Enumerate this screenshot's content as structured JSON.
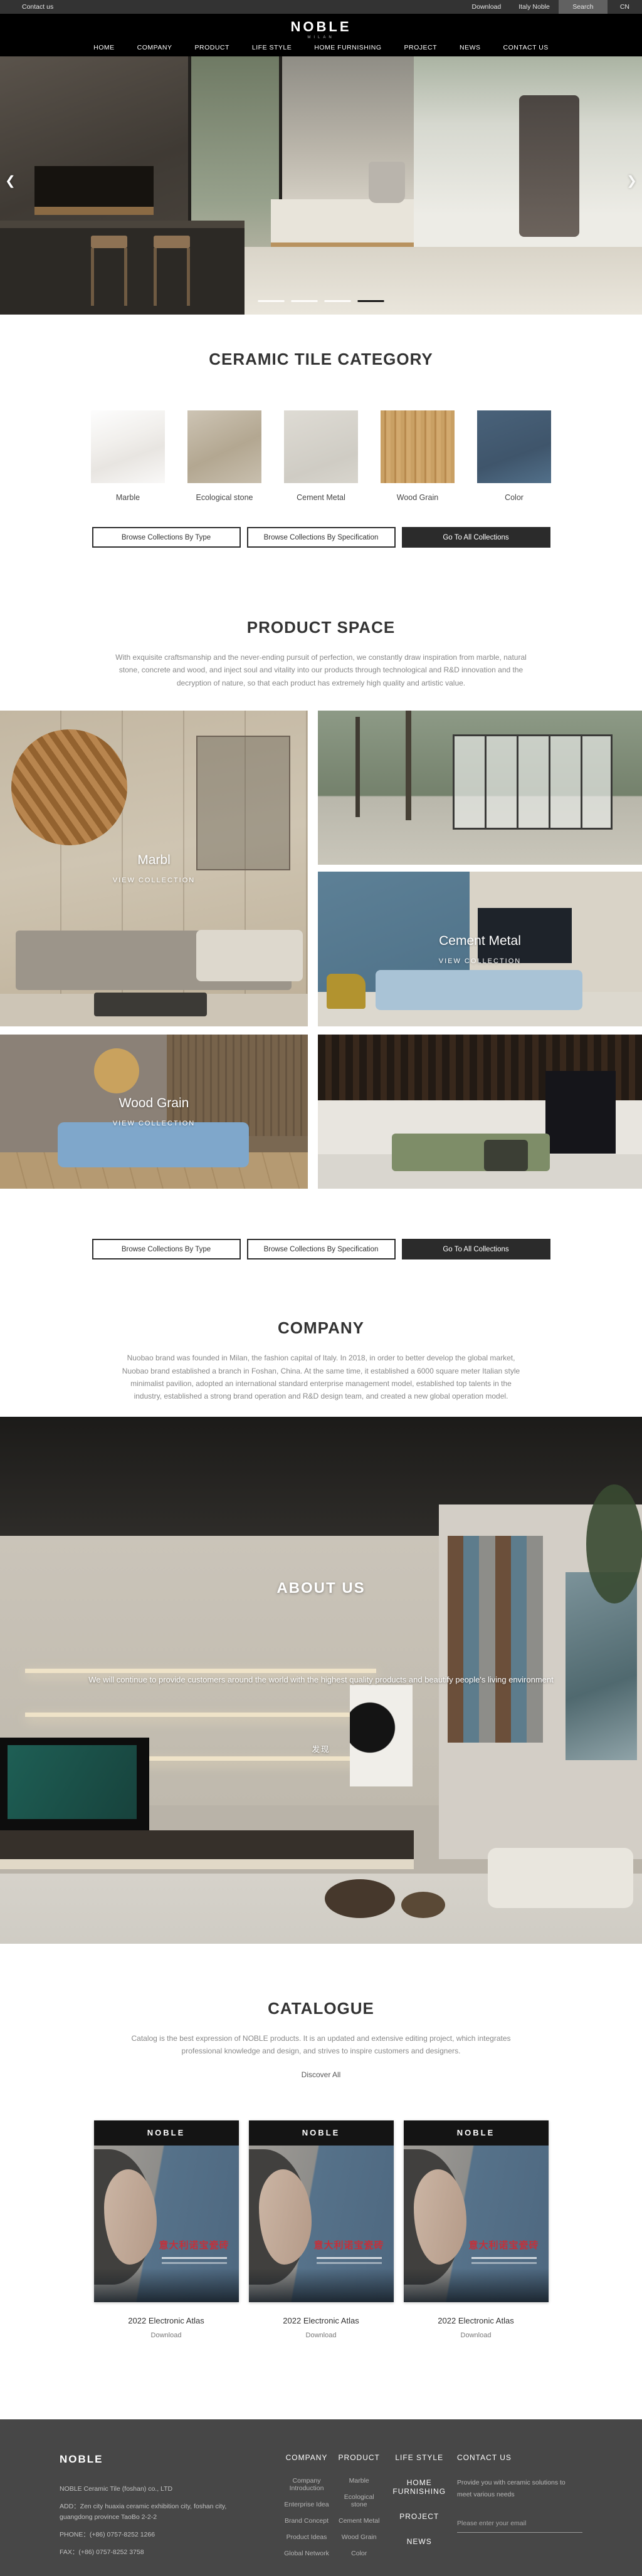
{
  "colors": {
    "accent_dark": "#2b2b2b",
    "topbar_bg": "#333333",
    "footer_bg": "#474747",
    "cover_red": "#c5303a",
    "cover_blue": "#56728a",
    "indicator_active": "#151515"
  },
  "topbar": {
    "contact": "Contact us",
    "download": "Download",
    "italy": "Italy Noble",
    "search": "Search",
    "lang": "CN"
  },
  "header": {
    "logo": "NOBLE",
    "logo_sub": "MILAN",
    "nav": [
      "HOME",
      "COMPANY",
      "PRODUCT",
      "LIFE STYLE",
      "HOME FURNISHING",
      "PROJECT",
      "NEWS",
      "CONTACT US"
    ]
  },
  "hero": {
    "prev": "❮",
    "next": "❯",
    "slide_count": 4,
    "active_slide": 4
  },
  "category": {
    "title": "CERAMIC TILE CATEGORY",
    "items": [
      {
        "label": "Marble"
      },
      {
        "label": "Ecological stone"
      },
      {
        "label": "Cement Metal"
      },
      {
        "label": "Wood Grain"
      },
      {
        "label": "Color"
      }
    ]
  },
  "buttons": {
    "by_type": "Browse Collections By Type",
    "by_spec": "Browse Collections By Specification",
    "all": "Go To All Collections"
  },
  "product_space": {
    "title": "PRODUCT SPACE",
    "description": "With exquisite craftsmanship and the never-ending pursuit of perfection, we constantly draw inspiration from marble, natural stone, concrete and wood, and inject soul and vitality into our products through technological and R&D innovation and the decryption of nature, so that each product has extremely high quality and artistic value.",
    "tiles": [
      {
        "name": "Marbl",
        "cta": "VIEW COLLECTION"
      },
      {
        "name": "Cement Metal",
        "cta": "VIEW COLLECTION"
      },
      {
        "name": "Wood Grain",
        "cta": "VIEW COLLECTION"
      }
    ]
  },
  "company": {
    "title": "COMPANY",
    "description": "Nuobao brand was founded in Milan, the fashion capital of Italy. In 2018, in order to better develop the global market, Nuobao brand established a branch in Foshan, China. At the same time, it established a 6000 square meter Italian style minimalist pavilion, adopted an international standard enterprise management model, established top talents in the industry, established a strong brand operation and R&D design team, and created a new global operation model."
  },
  "about": {
    "title": "ABOUT US",
    "caption": "We will continue to provide customers around the world with the highest quality products and beautify people's living environment",
    "more": "发现"
  },
  "catalogue": {
    "title": "CATALOGUE",
    "description": "Catalog is the best expression of NOBLE products. It is an updated and extensive editing project, which integrates professional knowledge and design, and strives to inspire customers and designers.",
    "discover": "Discover All",
    "items": [
      {
        "brand": "NOBLE",
        "title_cn": "意大利诺宝瓷砖",
        "name": "2022 Electronic Atlas",
        "download": "Download"
      },
      {
        "brand": "NOBLE",
        "title_cn": "意大利诺宝瓷砖",
        "name": "2022 Electronic Atlas",
        "download": "Download"
      },
      {
        "brand": "NOBLE",
        "title_cn": "意大利诺宝瓷砖",
        "name": "2022 Electronic Atlas",
        "download": "Download"
      }
    ]
  },
  "footer": {
    "logo": "NOBLE",
    "company_name": "NOBLE Ceramic Tile (foshan) co., LTD",
    "address": "ADD：Zen city huaxia ceramic exhibition city, foshan city, guangdong province TaoBo 2-2-2",
    "phone": "PHONE：(+86) 0757-8252 1266",
    "fax": "FAX：(+86) 0757-8252 3758",
    "columns": [
      {
        "title": "COMPANY",
        "links": [
          "Company Introduction",
          "Enterprise Idea",
          "Brand Concept",
          "Product Ideas",
          "Global Network"
        ]
      },
      {
        "title": "PRODUCT",
        "links": [
          "Marble",
          "Ecological stone",
          "Cement Metal",
          "Wood Grain",
          "Color"
        ]
      }
    ],
    "menu": [
      "LIFE STYLE",
      "HOME FURNISHING",
      "PROJECT",
      "NEWS"
    ],
    "contact": {
      "title": "CONTACT US",
      "text": "Provide you with ceramic solutions to meet various needs",
      "email_placeholder": "Please enter your email"
    }
  }
}
